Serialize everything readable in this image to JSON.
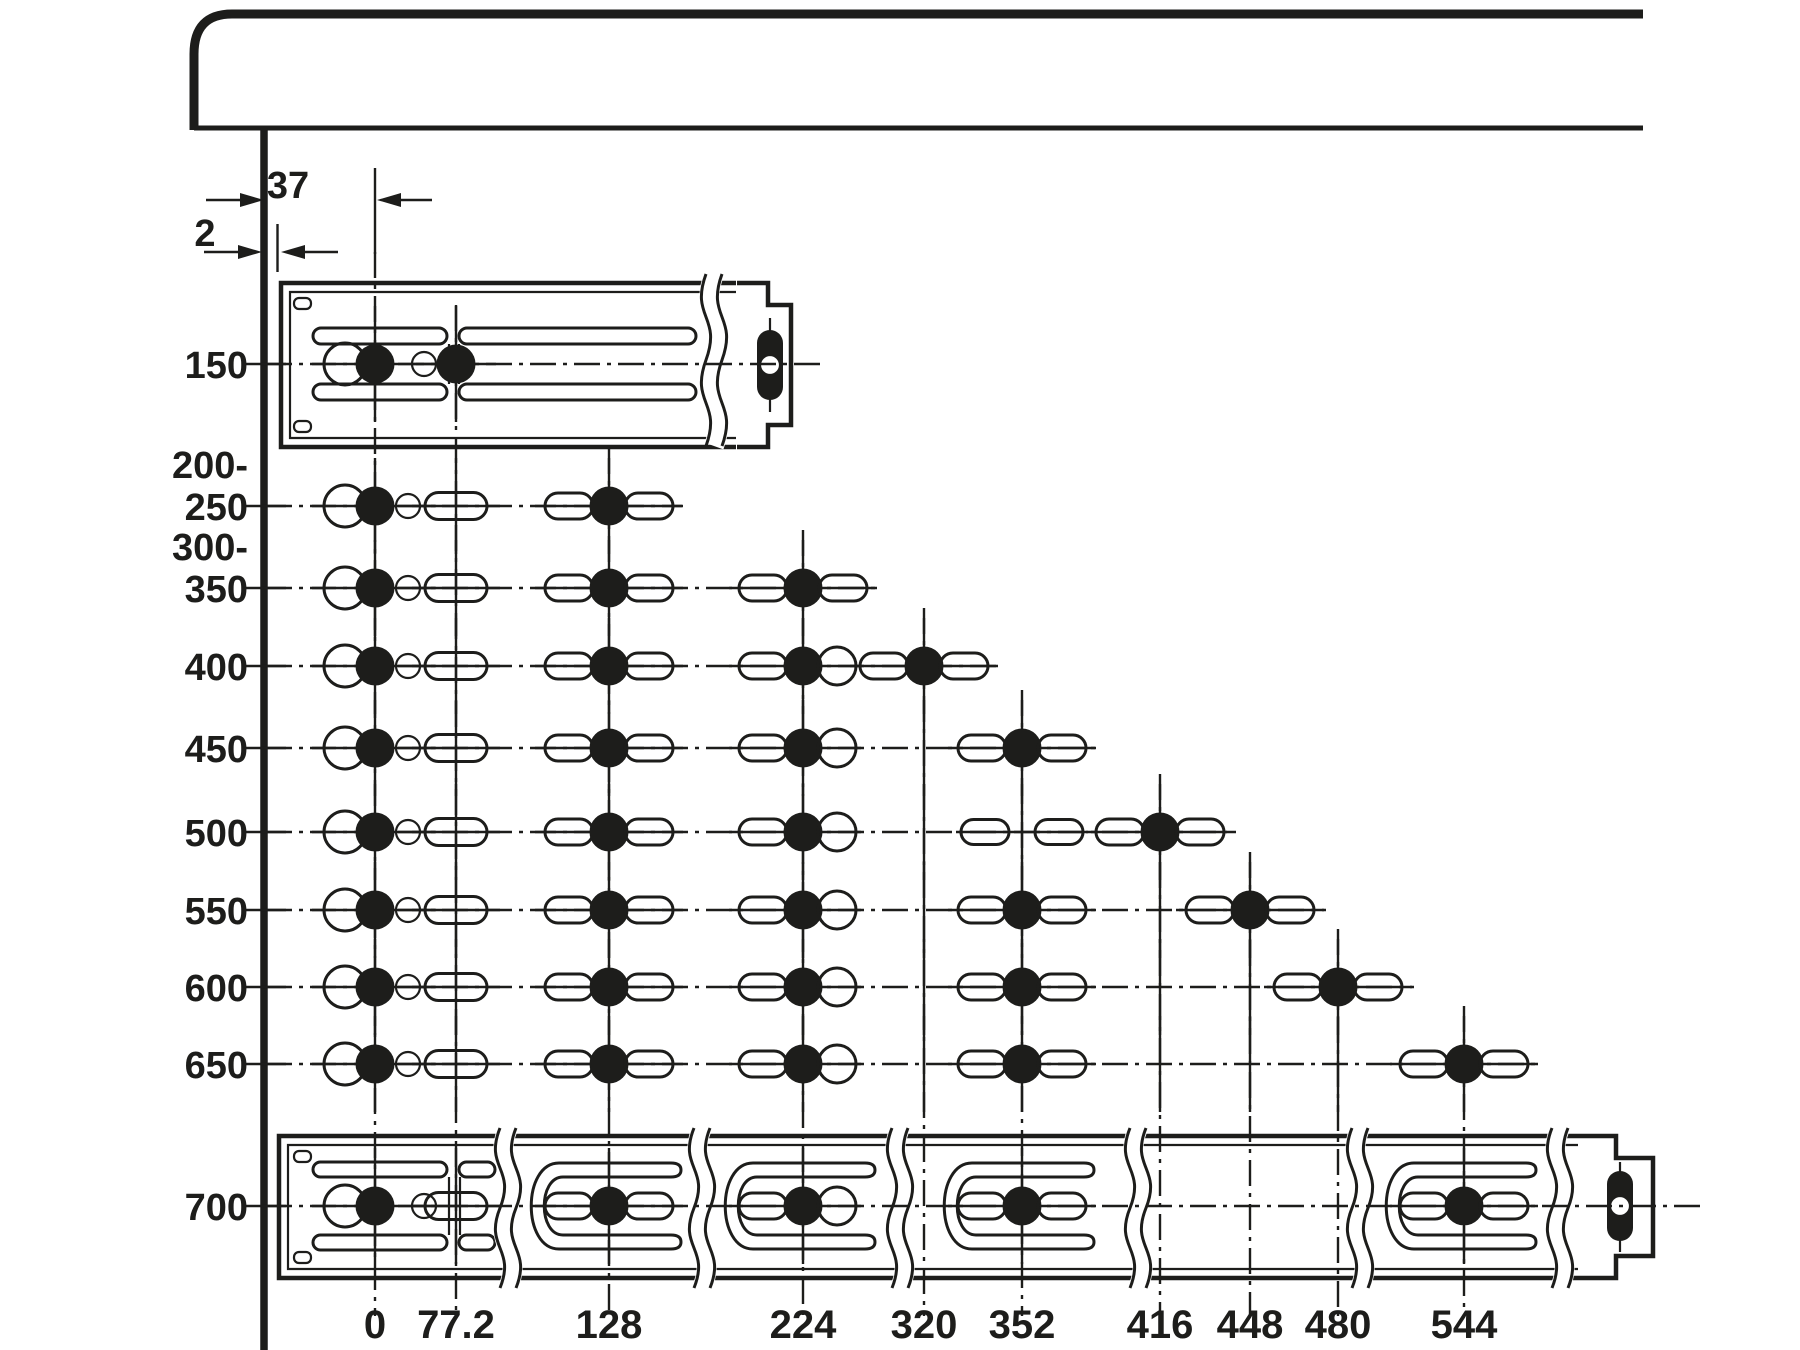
{
  "diagram": {
    "background": "#ffffff",
    "ink_color": "#1d1d1b",
    "dimensions": {
      "front_hole_offset": "37",
      "wall_gap": "2"
    },
    "column_label_y": 1338,
    "column_line_bottom": 1316,
    "columns": [
      {
        "label": "0",
        "x": 375,
        "line_top": 252
      },
      {
        "label": "77.2",
        "x": 456,
        "line_top": 305
      },
      {
        "label": "128",
        "x": 609,
        "line_top": 448
      },
      {
        "label": "224",
        "x": 803,
        "line_top": 530
      },
      {
        "label": "320",
        "x": 924,
        "line_top": 608
      },
      {
        "label": "352",
        "x": 1022,
        "line_top": 690
      },
      {
        "label": "416",
        "x": 1160,
        "line_top": 774
      },
      {
        "label": "448",
        "x": 1250,
        "line_top": 852
      },
      {
        "label": "480",
        "x": 1338,
        "line_top": 929
      },
      {
        "label": "544",
        "x": 1464,
        "line_top": 1006
      }
    ],
    "rows": [
      {
        "label": "150",
        "y": 364,
        "rail": "top",
        "line_end": 822,
        "groups": [
          {
            "col": 375,
            "type": "front"
          },
          {
            "col": 456,
            "type": "filled"
          }
        ]
      },
      {
        "label": "200-",
        "label2": "250",
        "y": 506,
        "line_end": 682,
        "groups": [
          {
            "col": 375,
            "type": "front"
          },
          {
            "col": 456,
            "type": "slot"
          },
          {
            "col": 609,
            "type": "sfs"
          }
        ]
      },
      {
        "label": "300-",
        "label2": "350",
        "y": 588,
        "line_end": 876,
        "groups": [
          {
            "col": 375,
            "type": "front"
          },
          {
            "col": 456,
            "type": "slot"
          },
          {
            "col": 609,
            "type": "sfs"
          },
          {
            "col": 803,
            "type": "sfs"
          }
        ]
      },
      {
        "label": "400",
        "y": 666,
        "line_end": 1002,
        "groups": [
          {
            "col": 375,
            "type": "front"
          },
          {
            "col": 456,
            "type": "slot"
          },
          {
            "col": 609,
            "type": "sfs"
          },
          {
            "col": 803,
            "type": "sfo"
          },
          {
            "col": 924,
            "type": "sfs"
          }
        ]
      },
      {
        "label": "450",
        "y": 748,
        "line_end": 1096,
        "groups": [
          {
            "col": 375,
            "type": "front"
          },
          {
            "col": 456,
            "type": "slot"
          },
          {
            "col": 609,
            "type": "sfs"
          },
          {
            "col": 803,
            "type": "sfo"
          },
          {
            "col": 924,
            "type": "cross"
          },
          {
            "col": 1022,
            "type": "sfs"
          }
        ]
      },
      {
        "label": "500",
        "y": 832,
        "line_end": 1236,
        "groups": [
          {
            "col": 375,
            "type": "front"
          },
          {
            "col": 456,
            "type": "slot"
          },
          {
            "col": 609,
            "type": "sfs"
          },
          {
            "col": 803,
            "type": "sfo"
          },
          {
            "col": 924,
            "type": "cross"
          },
          {
            "col": 1022,
            "type": "flank"
          },
          {
            "col": 1160,
            "type": "sfs"
          }
        ]
      },
      {
        "label": "550",
        "y": 910,
        "line_end": 1326,
        "groups": [
          {
            "col": 375,
            "type": "front"
          },
          {
            "col": 456,
            "type": "slot"
          },
          {
            "col": 609,
            "type": "sfs"
          },
          {
            "col": 803,
            "type": "sfo"
          },
          {
            "col": 924,
            "type": "cross"
          },
          {
            "col": 1022,
            "type": "sfs"
          },
          {
            "col": 1160,
            "type": "cross"
          },
          {
            "col": 1250,
            "type": "sfs"
          }
        ]
      },
      {
        "label": "600",
        "y": 987,
        "line_end": 1414,
        "groups": [
          {
            "col": 375,
            "type": "front"
          },
          {
            "col": 456,
            "type": "slot"
          },
          {
            "col": 609,
            "type": "sfs"
          },
          {
            "col": 803,
            "type": "sfo"
          },
          {
            "col": 924,
            "type": "cross"
          },
          {
            "col": 1022,
            "type": "sfs"
          },
          {
            "col": 1160,
            "type": "cross"
          },
          {
            "col": 1250,
            "type": "cross"
          },
          {
            "col": 1338,
            "type": "sfs"
          }
        ]
      },
      {
        "label": "650",
        "y": 1064,
        "line_end": 1540,
        "groups": [
          {
            "col": 375,
            "type": "front"
          },
          {
            "col": 456,
            "type": "slot"
          },
          {
            "col": 609,
            "type": "sfs"
          },
          {
            "col": 803,
            "type": "sfo"
          },
          {
            "col": 924,
            "type": "cross"
          },
          {
            "col": 1022,
            "type": "sfs"
          },
          {
            "col": 1160,
            "type": "cross"
          },
          {
            "col": 1250,
            "type": "cross"
          },
          {
            "col": 1338,
            "type": "cross"
          },
          {
            "col": 1464,
            "type": "sfs"
          }
        ]
      },
      {
        "label": "700",
        "y": 1206,
        "rail": "bottom",
        "line_end": 1700,
        "groups": [
          {
            "col": 375,
            "type": "front"
          },
          {
            "col": 456,
            "type": "slot"
          },
          {
            "col": 609,
            "type": "sfs",
            "cutout": true
          },
          {
            "col": 803,
            "type": "sfo",
            "cutout": true
          },
          {
            "col": 1022,
            "type": "sfs",
            "cutout": true
          },
          {
            "col": 1464,
            "type": "sfs",
            "cutout": true
          }
        ]
      }
    ]
  }
}
